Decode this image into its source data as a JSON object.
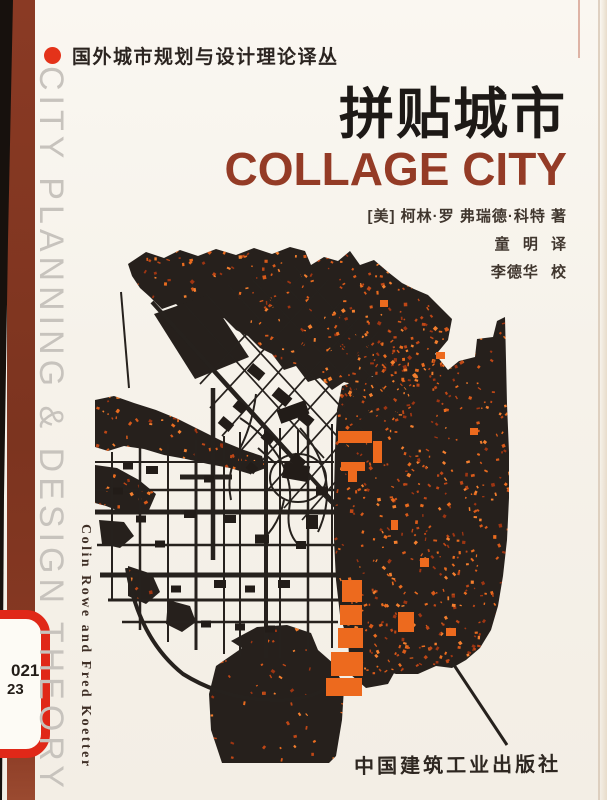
{
  "cover": {
    "series_label": "国外城市规划与设计理论译丛",
    "title_cn": "拼贴城市",
    "title_en": "COLLAGE CITY",
    "byline": "[美] 柯林·罗 弗瑞德·科特 著",
    "translator_line": "童 明 译",
    "proofreader_line": "李德华 校",
    "publisher": "中国建筑工业出版社",
    "spine_text": "CITY PLANNING & DESIGN THEORY",
    "side_authors": "Colin Rowe and Fred Koetter",
    "sticker": {
      "line1": "021",
      "line2": "23"
    },
    "colors": {
      "spine_bar": "#8a3a24",
      "accent_red": "#e4331a",
      "title_en_color": "#943b26",
      "spine_text_color": "#c7c3bd",
      "sticker_border": "#e02818",
      "map_black": "#26201c",
      "map_orange": "#ed6a1e",
      "map_orange_palette": [
        "#9e3512",
        "#bf4716",
        "#d85a1a",
        "#ea6c1f",
        "#f47f2e"
      ],
      "paper": "#f6f2ea"
    }
  }
}
